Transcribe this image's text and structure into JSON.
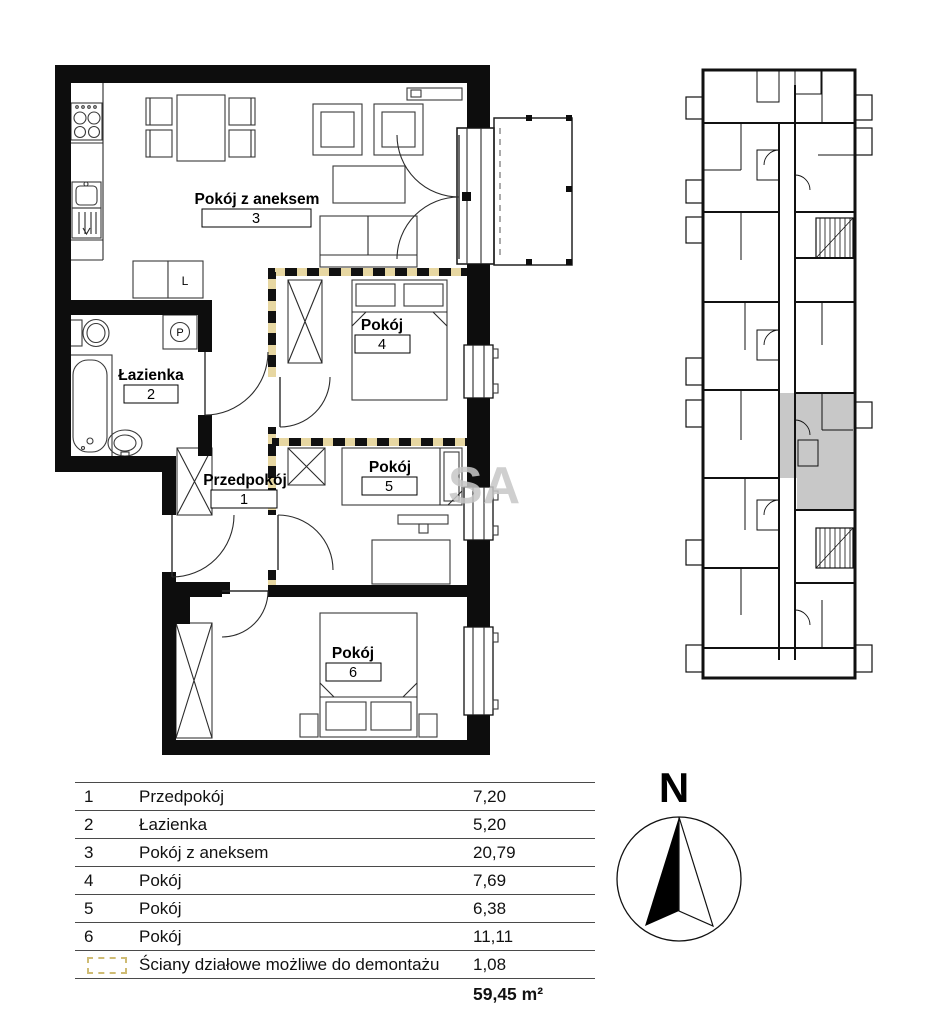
{
  "plan": {
    "rooms": [
      {
        "label": "Pokój z aneksem",
        "number": "3"
      },
      {
        "label": "Pokój",
        "number": "4"
      },
      {
        "label": "Pokój",
        "number": "5"
      },
      {
        "label": "Pokój",
        "number": "6"
      },
      {
        "label": "Łazienka",
        "number": "2"
      },
      {
        "label": "Przedpokój",
        "number": "1"
      }
    ],
    "fridge_label": "L",
    "washer_label": "P",
    "watermark": "SA"
  },
  "legend_table": {
    "rows": [
      {
        "no": "1",
        "name": "Przedpokój",
        "area": "7,20"
      },
      {
        "no": "2",
        "name": "Łazienka",
        "area": "5,20"
      },
      {
        "no": "3",
        "name": "Pokój z aneksem",
        "area": "20,79"
      },
      {
        "no": "4",
        "name": "Pokój",
        "area": "7,69"
      },
      {
        "no": "5",
        "name": "Pokój",
        "area": "6,38"
      },
      {
        "no": "6",
        "name": "Pokój",
        "area": "11,11"
      }
    ],
    "demountable_row": {
      "name": "Ściany działowe możliwe do demontażu",
      "area": "1,08"
    },
    "total": "59,45 m²"
  },
  "compass": {
    "label": "N"
  },
  "colors": {
    "demountable_wall": "#e7d7a2",
    "highlight_unit": "#c8c8c8"
  }
}
